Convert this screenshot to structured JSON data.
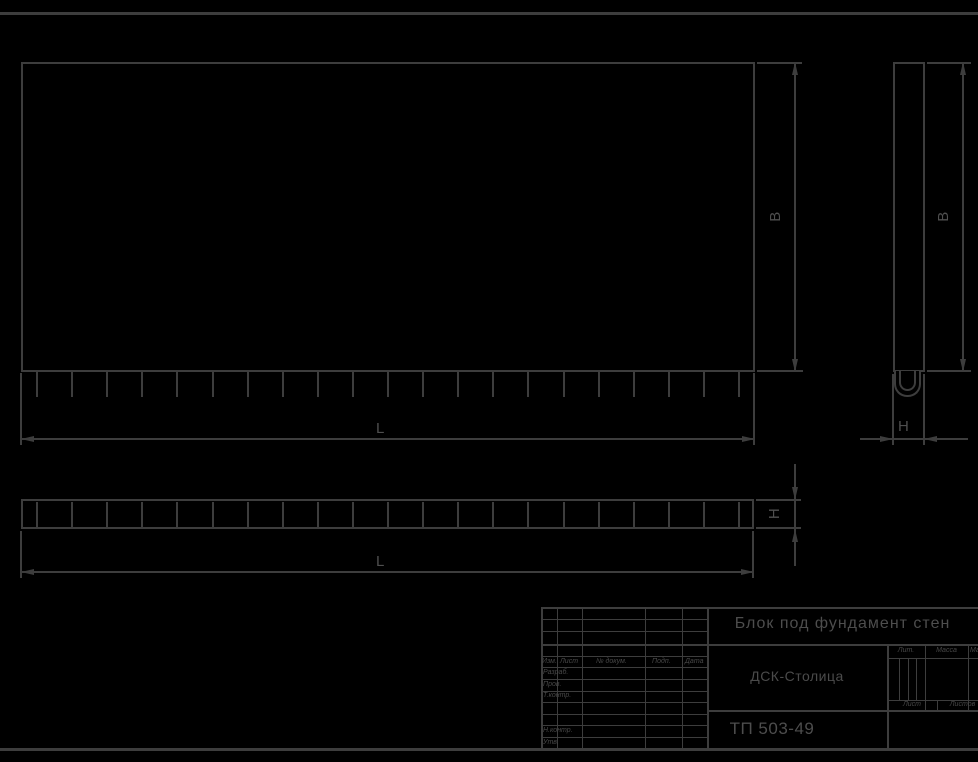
{
  "dims": {
    "length": "L",
    "width": "B",
    "height": "H"
  },
  "views": {
    "front": {
      "tick_count": 21
    },
    "plan": {
      "segment_count": 21
    }
  },
  "title_block": {
    "title": "Блок под фундамент стен",
    "company": "ДСК-Столица",
    "doc_number": "ТП 503-49",
    "columns": {
      "izm": "Изм.",
      "list": "Лист",
      "doc": "№ докум.",
      "podp": "Подп.",
      "data": "Дата"
    },
    "rows": {
      "razrab": "Разраб.",
      "prov": "Пров.",
      "tkontr": "Т.контр.",
      "nkontr": "Н.контр.",
      "utv": "Утв."
    },
    "right": {
      "lit": "Лит.",
      "massa": "Масса",
      "masshtab": "Масштаб",
      "sheet": "Лист",
      "sheets": "Листов"
    }
  },
  "colors": {
    "background": "#000000",
    "line": "#3d3d3d",
    "text": "#4d4d4d"
  }
}
